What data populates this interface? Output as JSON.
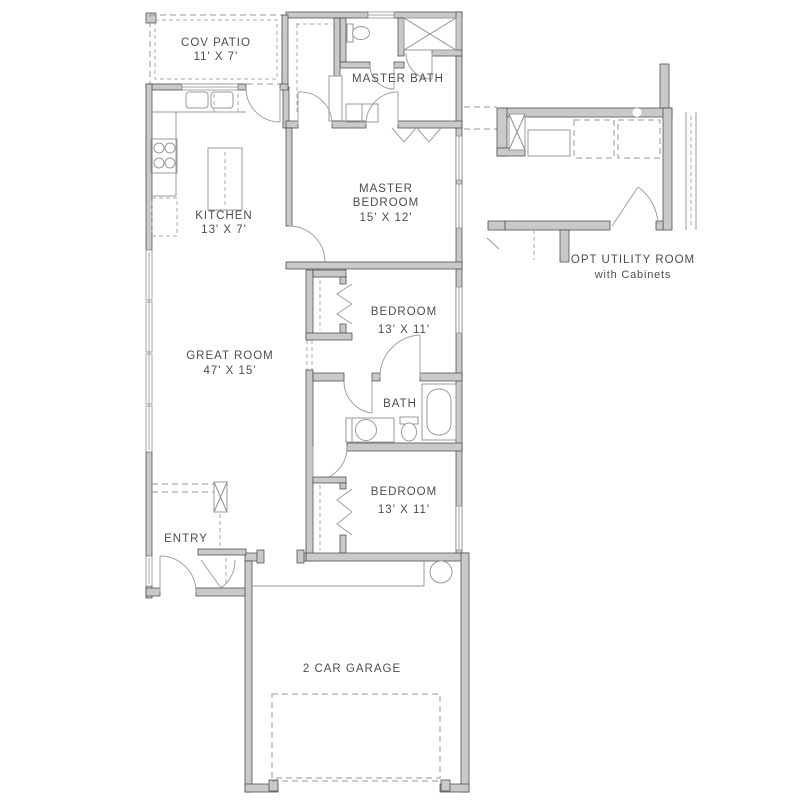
{
  "rooms": {
    "cov_patio": {
      "name": "COV PATIO",
      "dims": "11' X 7'"
    },
    "master_bath": {
      "name": "MASTER BATH"
    },
    "kitchen": {
      "name": "KITCHEN",
      "dims": "13' X 7'"
    },
    "master_bedroom": {
      "line1": "MASTER",
      "line2": "BEDROOM",
      "dims": "15' X 12'"
    },
    "bedroom_1": {
      "name": "BEDROOM",
      "dims": "13' X 11'"
    },
    "great_room": {
      "name": "GREAT ROOM",
      "dims": "47' X 15'"
    },
    "bath": {
      "name": "BATH"
    },
    "bedroom_2": {
      "name": "BEDROOM",
      "dims": "13' X 11'"
    },
    "entry": {
      "name": "ENTRY"
    },
    "garage": {
      "name": "2 CAR GARAGE"
    },
    "opt_utility": {
      "name": "OPT UTILITY ROOM",
      "sub": "with Cabinets"
    }
  }
}
